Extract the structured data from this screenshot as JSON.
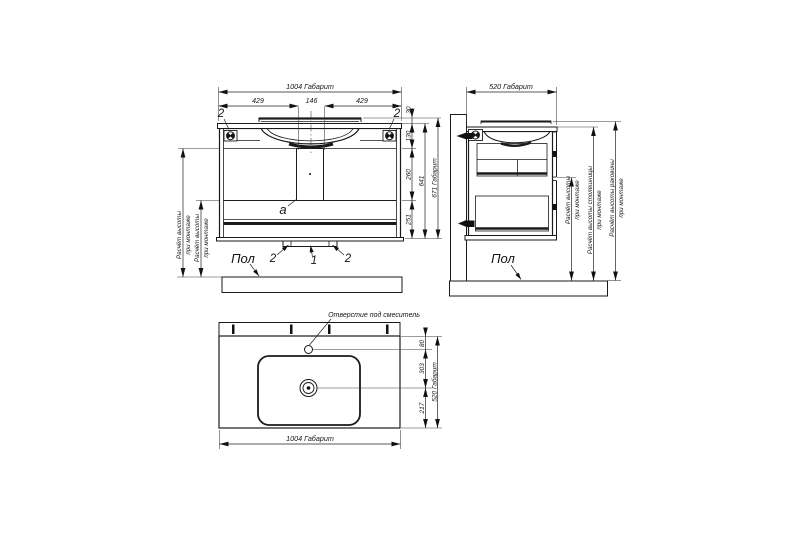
{
  "drawing": {
    "front_view": {
      "dim_width_total": "1004 Габарит",
      "dim_width_left": "429",
      "dim_width_center": "146",
      "dim_width_right": "429",
      "clip_label_left": "2",
      "clip_label_right": "2",
      "dim_rim_height": "30",
      "dim_apron_height": "130",
      "dim_upper_height": "260",
      "dim_lower_height": "251",
      "dim_body_height": "641",
      "dim_height_total": "671 Габарит",
      "siphon_label": "a",
      "foot_label_left": "2",
      "foot_label_center": "1",
      "foot_label_right": "2",
      "floor_label": "Пол",
      "mount_calc_outer_line1": "Расчёт высоты",
      "mount_calc_outer_line2": "при монтаже",
      "mount_calc_inner_line1": "Расчёт высоты",
      "mount_calc_inner_line2": "при монтаже"
    },
    "side_view": {
      "dim_depth_total": "520 Габарит",
      "floor_label": "Пол",
      "mount_calc_height_line1": "Расчёт высоты",
      "mount_calc_height_line2": "при монтаже",
      "mount_calc_countertop_line1": "Расчёт высоты столешницы",
      "mount_calc_countertop_line2": "при монтаже",
      "mount_calc_sink_line1": "Расчёт высоты раковины",
      "mount_calc_sink_line2": "при монтаже"
    },
    "top_view": {
      "faucet_hole_label": "Отверстие под смеситель",
      "dim_faucet_offset": "80",
      "dim_drain_offset": "303",
      "dim_front_offset": "217",
      "dim_depth_total": "520 Габарит",
      "dim_width_total": "1004 Габарит"
    },
    "icons": {
      "fastener": "cam-lock-icon",
      "wall_bracket": "wall-mount-bracket-icon"
    },
    "colors": {
      "line": "#1a1a1a",
      "background": "#ffffff"
    }
  }
}
